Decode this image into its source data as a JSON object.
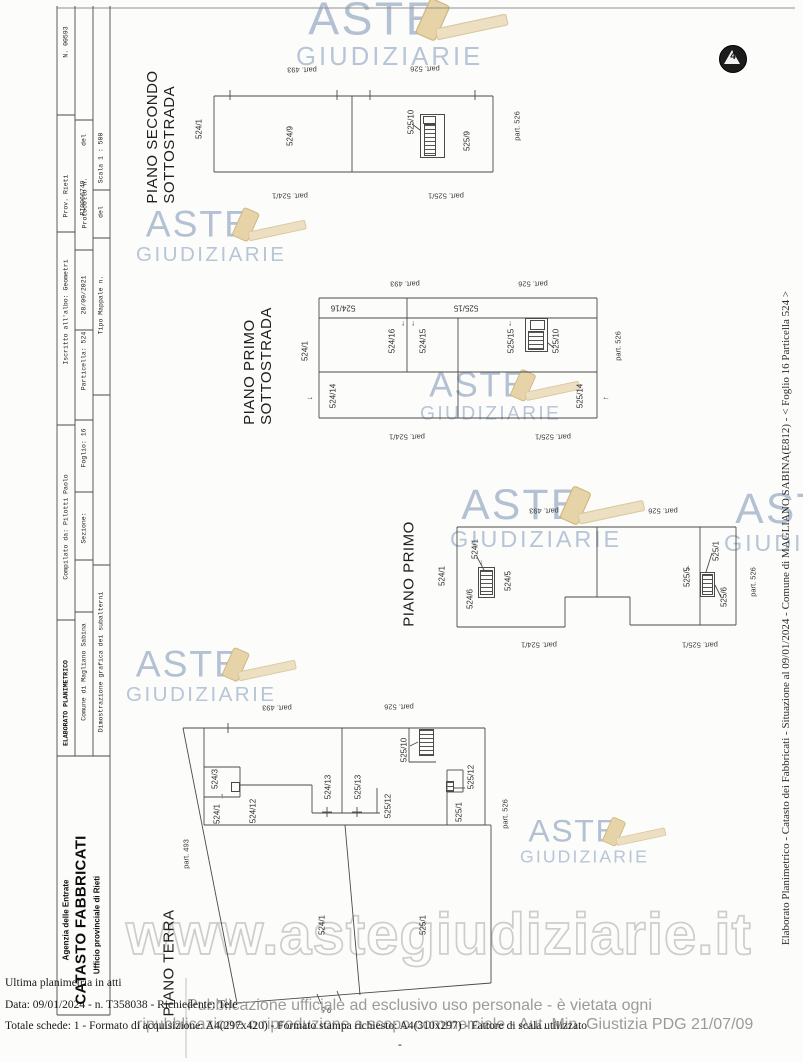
{
  "colors": {
    "line": "#4a4a4a",
    "logo_text": "#b3c1d3",
    "gavel": "#e6d3a8",
    "watermark_stroke": "#cdcdcd",
    "notice": "#9b9b9b"
  },
  "watermark_text": "www.astegiudiziarie.it",
  "logo_words": {
    "aste": "ASTE",
    "giudiziarie": "GIUDIZIARIE"
  },
  "stamp": {
    "glyph": "4"
  },
  "side_text": "Elaborato Planimetrico - Catasto dei Fabbricati - Situazione al 09/01/2024 - Comune di MAGLIANO SABINA(E812) - < Foglio 16 Particella 524 >",
  "footer": {
    "line1": "Ultima planimetria in atti",
    "line2": "Data: 09/01/2024 - n. T358038 - Richiedente: Tele",
    "line3": "Totale schede: 1 - Formato di acquisizione: A4(297x420) - Formato stampa richiesto: A4(310x297) - Fattore di scala utilizzato",
    "dash": "-"
  },
  "notice": {
    "line1": "Pubblicazione ufficiale ad esclusivo uso personale - è vietata ogni",
    "line2": "ripubblicazione o riproduzione a scopo commerciale - Aut. Min. Giustizia PDG 21/07/09"
  },
  "agency": {
    "line1": "Agenzia delle Entrate",
    "line2": "CATASTO FABBRICATI",
    "line3": "Ufficio provinciale di Rieti"
  },
  "band": {
    "row1": [
      "ELABORATO PLANIMETRICO",
      "Compilato da: Pilotti Paolo",
      "Iscritto all'albo: Geometri",
      "Prov. Rieti",
      "N. 00593"
    ],
    "row2": [
      "Comune di Magliano Sabina",
      "Sezione:",
      "Foglio: 16",
      "Particella: 524",
      "Protocollo n.",
      "RI0066749",
      "28/09/2021",
      "del"
    ],
    "row3": [
      "Dimostrazione grafica dei subalterni",
      "Tipo Mappale n.",
      "del",
      "Scala 1 : 500"
    ]
  },
  "titles": [
    {
      "lines": [
        "PIANO SECONDO",
        "SOTTOSTRADA"
      ],
      "x": 161,
      "y": 137
    },
    {
      "lines": [
        "PIANO PRIMO",
        "SOTTOSTRADA"
      ],
      "x": 258,
      "y": 366
    },
    {
      "lines": [
        "PIANO PRIMO"
      ],
      "x": 409,
      "y": 574
    },
    {
      "lines": [
        "PIANO TERRA"
      ],
      "x": 169,
      "y": 963
    }
  ],
  "labels": [
    {
      "t": "N. 00593",
      "x": 66,
      "y": 42,
      "c": "bl"
    },
    {
      "t": "Prov. Rieti",
      "x": 66,
      "y": 196,
      "c": "bl"
    },
    {
      "t": "Iscritto all'albo: Geometri",
      "x": 66,
      "y": 312,
      "c": "bl"
    },
    {
      "t": "Compilato da: Pilotti Paolo",
      "x": 66,
      "y": 527,
      "c": "bl"
    },
    {
      "t": "ELABORATO PLANIMETRICO",
      "x": 66,
      "y": 703,
      "c": "blb"
    },
    {
      "t": "del",
      "x": 84,
      "y": 140,
      "c": "bl"
    },
    {
      "t": "RI0066749",
      "x": 83,
      "y": 198,
      "c": "bl"
    },
    {
      "t": "Protocollo n.",
      "x": 85,
      "y": 203,
      "c": "bl"
    },
    {
      "t": "28/09/2021",
      "x": 84,
      "y": 295,
      "c": "bl"
    },
    {
      "t": "Particella: 524",
      "x": 84,
      "y": 361,
      "c": "bl"
    },
    {
      "t": "Foglio: 16",
      "x": 84,
      "y": 448,
      "c": "bl"
    },
    {
      "t": "Sezione:",
      "x": 84,
      "y": 528,
      "c": "bl"
    },
    {
      "t": "Comune di Magliano Sabina",
      "x": 84,
      "y": 672,
      "c": "bl"
    },
    {
      "t": "Scala 1 : 500",
      "x": 101,
      "y": 158,
      "c": "bl"
    },
    {
      "t": "del",
      "x": 101,
      "y": 212,
      "c": "bl"
    },
    {
      "t": "Tipo Mappale n.",
      "x": 101,
      "y": 305,
      "c": "bl"
    },
    {
      "t": "Dimostrazione grafica dei subalterni",
      "x": 101,
      "y": 662,
      "c": "bl"
    },
    {
      "t": "524/1",
      "x": 199,
      "y": 129,
      "c": "lb"
    },
    {
      "t": "524/9",
      "x": 290,
      "y": 136,
      "c": "lb"
    },
    {
      "t": "525/10",
      "x": 411,
      "y": 122,
      "c": "lb"
    },
    {
      "t": "525/9",
      "x": 467,
      "y": 141,
      "c": "lb"
    },
    {
      "t": "part. 526",
      "x": 517,
      "y": 126,
      "c": "pt"
    },
    {
      "t": "part. 493",
      "x": 302,
      "y": 70,
      "r": 180,
      "c": "pt"
    },
    {
      "t": "part. 526",
      "x": 425,
      "y": 69,
      "r": 180,
      "c": "pt"
    },
    {
      "t": "part. 524/1",
      "x": 290,
      "y": 196,
      "r": 180,
      "c": "pt"
    },
    {
      "t": "part. 525/1",
      "x": 446,
      "y": 196,
      "r": 180,
      "c": "pt"
    },
    {
      "t": "524/16",
      "x": 343,
      "y": 308,
      "r": 180,
      "c": "lb"
    },
    {
      "t": "525/15",
      "x": 466,
      "y": 308,
      "r": 180,
      "c": "lb"
    },
    {
      "t": "524/16",
      "x": 392,
      "y": 341,
      "c": "lb"
    },
    {
      "t": "524/15",
      "x": 423,
      "y": 341,
      "c": "lb"
    },
    {
      "t": "525/15",
      "x": 511,
      "y": 341,
      "c": "lb"
    },
    {
      "t": "525/10",
      "x": 556,
      "y": 341,
      "c": "lb"
    },
    {
      "t": "524/14",
      "x": 333,
      "y": 396,
      "c": "lb"
    },
    {
      "t": "525/14",
      "x": 580,
      "y": 396,
      "c": "lb"
    },
    {
      "t": "524/1",
      "x": 305,
      "y": 351,
      "c": "lb"
    },
    {
      "t": "part. 526",
      "x": 618,
      "y": 346,
      "c": "pt"
    },
    {
      "t": "part. 493",
      "x": 405,
      "y": 284,
      "r": 180,
      "c": "pt"
    },
    {
      "t": "part. 526",
      "x": 533,
      "y": 284,
      "r": 180,
      "c": "pt"
    },
    {
      "t": "part. 524/1",
      "x": 407,
      "y": 437,
      "r": 180,
      "c": "pt"
    },
    {
      "t": "part. 525/1",
      "x": 553,
      "y": 437,
      "r": 180,
      "c": "pt"
    },
    {
      "t": "↓",
      "x": 403,
      "y": 323,
      "r": 0,
      "c": "ar"
    },
    {
      "t": "↓",
      "x": 413,
      "y": 323,
      "r": 0,
      "c": "ar"
    },
    {
      "t": "↓",
      "x": 510,
      "y": 323,
      "r": 0,
      "c": "ar"
    },
    {
      "t": "→",
      "x": 310,
      "y": 397,
      "r": 0,
      "c": "ar"
    },
    {
      "t": "←",
      "x": 606,
      "y": 397,
      "r": 0,
      "c": "ar"
    },
    {
      "t": "524/1",
      "x": 442,
      "y": 576,
      "c": "lb"
    },
    {
      "t": "524/1",
      "x": 475,
      "y": 549,
      "c": "lb"
    },
    {
      "t": "524/6",
      "x": 470,
      "y": 599,
      "c": "lb"
    },
    {
      "t": "524/5",
      "x": 508,
      "y": 581,
      "c": "lb"
    },
    {
      "t": "525/1",
      "x": 716,
      "y": 551,
      "c": "lb"
    },
    {
      "t": "525/5",
      "x": 687,
      "y": 577,
      "c": "lb"
    },
    {
      "t": "525/6",
      "x": 724,
      "y": 597,
      "c": "lb"
    },
    {
      "t": "part. 526",
      "x": 753,
      "y": 582,
      "c": "pt"
    },
    {
      "t": "part. 493",
      "x": 544,
      "y": 511,
      "r": 180,
      "c": "pt"
    },
    {
      "t": "part. 526",
      "x": 663,
      "y": 511,
      "r": 180,
      "c": "pt"
    },
    {
      "t": "part. 524/1",
      "x": 539,
      "y": 645,
      "r": 180,
      "c": "pt"
    },
    {
      "t": "part. 525/1",
      "x": 700,
      "y": 645,
      "r": 180,
      "c": "pt"
    },
    {
      "t": "↓",
      "x": 481,
      "y": 562,
      "r": 0,
      "c": "ar"
    },
    {
      "t": "↓",
      "x": 688,
      "y": 567,
      "r": 0,
      "c": "ar"
    },
    {
      "t": "524/3",
      "x": 215,
      "y": 779,
      "c": "lb"
    },
    {
      "t": "524/1",
      "x": 217,
      "y": 814,
      "c": "lb"
    },
    {
      "t": "524/12",
      "x": 253,
      "y": 811,
      "c": "lb"
    },
    {
      "t": "524/13",
      "x": 328,
      "y": 787,
      "c": "lb"
    },
    {
      "t": "525/13",
      "x": 358,
      "y": 787,
      "c": "lb"
    },
    {
      "t": "525/12",
      "x": 388,
      "y": 806,
      "c": "lb"
    },
    {
      "t": "525/10",
      "x": 404,
      "y": 750,
      "c": "lb"
    },
    {
      "t": "525/12",
      "x": 471,
      "y": 777,
      "c": "lb"
    },
    {
      "t": "525/1",
      "x": 459,
      "y": 812,
      "c": "lb"
    },
    {
      "t": "524/1",
      "x": 322,
      "y": 925,
      "c": "lb"
    },
    {
      "t": "525/1",
      "x": 423,
      "y": 925,
      "c": "lb"
    },
    {
      "t": "part. 493",
      "x": 186,
      "y": 854,
      "c": "pt"
    },
    {
      "t": "part. 526",
      "x": 505,
      "y": 814,
      "c": "pt"
    },
    {
      "t": "part. 493",
      "x": 277,
      "y": 708,
      "r": 180,
      "c": "pt"
    },
    {
      "t": "part. 526",
      "x": 399,
      "y": 707,
      "r": 180,
      "c": "pt"
    },
    {
      "t": "9.5",
      "x": 326,
      "y": 1010,
      "r": 184,
      "c": "pt"
    },
    {
      "t": "↑",
      "x": 222,
      "y": 796,
      "r": 0,
      "c": "ar"
    }
  ],
  "geometry": {
    "lines": [
      [
        57,
        8,
        795,
        8,
        "#909090"
      ],
      [
        57,
        6,
        57,
        1015
      ],
      [
        75,
        6,
        75,
        756
      ],
      [
        93,
        6,
        93,
        756
      ],
      [
        110,
        6,
        110,
        1015
      ],
      [
        57,
        756,
        110,
        756
      ],
      [
        57,
        1015,
        110,
        1015
      ],
      [
        57,
        115,
        75,
        115
      ],
      [
        57,
        232,
        75,
        232
      ],
      [
        57,
        425,
        75,
        425
      ],
      [
        57,
        620,
        75,
        620
      ],
      [
        75,
        120,
        93,
        120
      ],
      [
        75,
        250,
        93,
        250
      ],
      [
        75,
        330,
        93,
        330
      ],
      [
        75,
        420,
        93,
        420
      ],
      [
        75,
        492,
        93,
        492
      ],
      [
        75,
        560,
        93,
        560
      ],
      [
        75,
        612,
        93,
        612
      ],
      [
        93,
        190,
        110,
        190
      ],
      [
        93,
        238,
        110,
        238
      ],
      [
        93,
        395,
        110,
        395
      ],
      [
        93,
        565,
        110,
        565
      ],
      [
        186,
        978,
        186,
        1058,
        "#bbbbbb"
      ],
      [
        214,
        96,
        493,
        96
      ],
      [
        214,
        172,
        493,
        172
      ],
      [
        214,
        96,
        214,
        172
      ],
      [
        493,
        96,
        493,
        172
      ],
      [
        352,
        96,
        352,
        172
      ],
      [
        230,
        90,
        230,
        100
      ],
      [
        337,
        90,
        337,
        100
      ],
      [
        370,
        90,
        370,
        100
      ],
      [
        475,
        90,
        475,
        100
      ],
      [
        412,
        124,
        420,
        130
      ],
      [
        319,
        298,
        597,
        298
      ],
      [
        319,
        418,
        597,
        418
      ],
      [
        319,
        298,
        319,
        418
      ],
      [
        597,
        298,
        597,
        418
      ],
      [
        319,
        318,
        597,
        318
      ],
      [
        407,
        298,
        407,
        318
      ],
      [
        458,
        318,
        458,
        418
      ],
      [
        319,
        372,
        597,
        372
      ],
      [
        407,
        318,
        407,
        372
      ],
      [
        548,
        343,
        554,
        348
      ],
      [
        457,
        527,
        736,
        527
      ],
      [
        736,
        527,
        736,
        625
      ],
      [
        630,
        625,
        736,
        625
      ],
      [
        630,
        597,
        630,
        625
      ],
      [
        565,
        597,
        630,
        597
      ],
      [
        565,
        597,
        565,
        627
      ],
      [
        457,
        627,
        565,
        627
      ],
      [
        457,
        527,
        457,
        627
      ],
      [
        597,
        527,
        597,
        597
      ],
      [
        700,
        527,
        700,
        625
      ],
      [
        477,
        557,
        484,
        570
      ],
      [
        712,
        553,
        706,
        572
      ],
      [
        715,
        585,
        721,
        597
      ],
      [
        183,
        728,
        485,
        728
      ],
      [
        204,
        728,
        204,
        825
      ],
      [
        183,
        728,
        237,
        1003
      ],
      [
        204,
        825,
        485,
        825
      ],
      [
        485,
        728,
        485,
        825
      ],
      [
        485,
        825,
        491,
        825
      ],
      [
        491,
        825,
        491,
        983
      ],
      [
        237,
        1003,
        491,
        983
      ],
      [
        345,
        825,
        360,
        995
      ],
      [
        342,
        728,
        342,
        813
      ],
      [
        204,
        767,
        240,
        767
      ],
      [
        240,
        767,
        240,
        797
      ],
      [
        204,
        797,
        240,
        797
      ],
      [
        240,
        785,
        312,
        785
      ],
      [
        312,
        785,
        312,
        813
      ],
      [
        312,
        813,
        380,
        813
      ],
      [
        377,
        788,
        377,
        813
      ],
      [
        409,
        728,
        409,
        762
      ],
      [
        409,
        762,
        436,
        762
      ],
      [
        447,
        770,
        463,
        770
      ],
      [
        463,
        770,
        463,
        792
      ],
      [
        447,
        792,
        463,
        792
      ],
      [
        447,
        770,
        447,
        825
      ],
      [
        410,
        746,
        418,
        742
      ],
      [
        453,
        788,
        465,
        788
      ],
      [
        327,
        807,
        327,
        817
      ],
      [
        322,
        812,
        332,
        812
      ],
      [
        357,
        807,
        357,
        817
      ],
      [
        352,
        812,
        362,
        812
      ],
      [
        228,
        723,
        228,
        733
      ],
      [
        317,
        994,
        321,
        1004
      ],
      [
        337,
        991,
        341,
        1001
      ]
    ],
    "boxes": [
      [
        420,
        114,
        25,
        44
      ],
      [
        423,
        116,
        13,
        8
      ],
      [
        525,
        318,
        23,
        34
      ],
      [
        530,
        320,
        15,
        10
      ],
      [
        478,
        567,
        17,
        31
      ],
      [
        700,
        572,
        15,
        25
      ],
      [
        231,
        782,
        9,
        10
      ]
    ],
    "stairs": [
      [
        424,
        124,
        12,
        32
      ],
      [
        528,
        331,
        16,
        19
      ],
      [
        480,
        570,
        13,
        25
      ],
      [
        702,
        574,
        11,
        21
      ],
      [
        419,
        729,
        15,
        27
      ],
      [
        446,
        781,
        8,
        11
      ]
    ]
  },
  "logos": [
    {
      "x": 296,
      "y": -6,
      "s": 1.22
    },
    {
      "x": 136,
      "y": 204,
      "s": 0.98
    },
    {
      "x": 420,
      "y": 366,
      "s": 0.92
    },
    {
      "x": 450,
      "y": 482,
      "s": 1.12
    },
    {
      "x": 126,
      "y": 644,
      "s": 0.98
    },
    {
      "x": 520,
      "y": 814,
      "s": 0.84
    },
    {
      "x": 724,
      "y": 486,
      "s": 1.12
    }
  ],
  "agency_pos": [
    {
      "x": 66,
      "y": 920,
      "c": "ag1"
    },
    {
      "x": 81,
      "y": 920,
      "c": "ag2"
    },
    {
      "x": 97,
      "y": 925,
      "c": "ag1"
    }
  ]
}
